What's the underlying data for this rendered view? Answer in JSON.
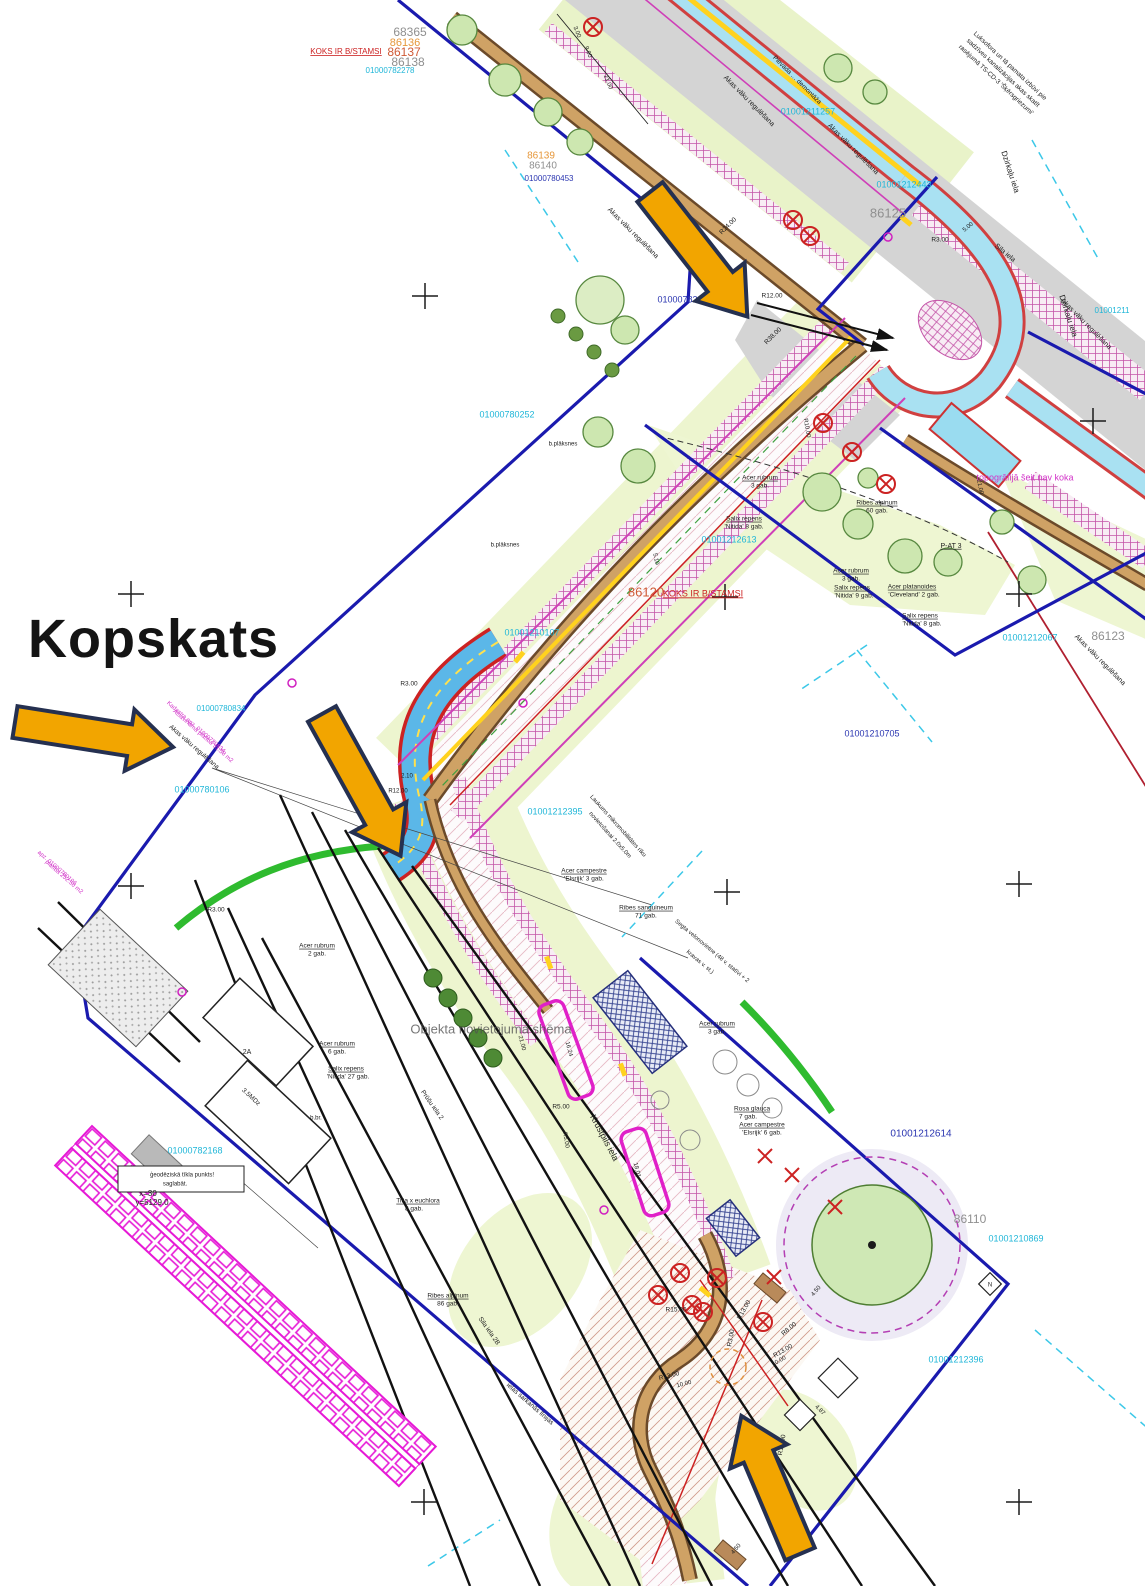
{
  "title": "Kopskats",
  "palette": {
    "cyan": "#1fb6d8",
    "blue": "#2a35b0",
    "red": "#cc2222",
    "magenta": "#d233c8",
    "orange": "#e6973a",
    "orangered": "#cf5a36",
    "dim": "#8f8f8f",
    "black": "#1d1d1d",
    "shadow": "rgba(80,80,80,0.78)",
    "arrow_fill": "#f2a500",
    "arrow_edge": "#253050"
  },
  "labels": [
    {
      "t": "68365",
      "x": 410,
      "y": 33,
      "c": "dim",
      "s": 12
    },
    {
      "t": "86136",
      "x": 405,
      "y": 43,
      "c": "orange",
      "s": 11
    },
    {
      "t": "KOKS IR B/STAMSI",
      "x": 346,
      "y": 52,
      "c": "red",
      "s": 8,
      "u": 1
    },
    {
      "t": "86137",
      "x": 404,
      "y": 53,
      "c": "orangered",
      "s": 12
    },
    {
      "t": "86138",
      "x": 408,
      "y": 63,
      "c": "dim",
      "s": 12
    },
    {
      "t": "01000782278",
      "x": 390,
      "y": 71,
      "c": "cyan",
      "s": 8
    },
    {
      "t": "86139",
      "x": 541,
      "y": 156,
      "c": "orange",
      "s": 10
    },
    {
      "t": "86140",
      "x": 543,
      "y": 166,
      "c": "dim",
      "s": 10
    },
    {
      "t": "01000780453",
      "x": 549,
      "y": 179,
      "c": "blue",
      "s": 8
    },
    {
      "t": "Luksofora un tā pamata izbūvi pie",
      "x": 1010,
      "y": 66,
      "r": 43,
      "s": 6.5
    },
    {
      "t": "sadzīves kanalizācijas akas skatīt",
      "x": 1003,
      "y": 73,
      "r": 43,
      "s": 6.5
    },
    {
      "t": "rasējumā TS-CD-3 'Šķērsgriezumi'",
      "x": 996,
      "y": 80,
      "r": 43,
      "s": 6.5
    },
    {
      "t": "Pievada … demontāža",
      "x": 797,
      "y": 80,
      "r": 45,
      "s": 6.5
    },
    {
      "t": "Akas vāku regulēšana",
      "x": 749,
      "y": 101,
      "r": 45,
      "s": 7
    },
    {
      "t": "Akas vāku regulēšana",
      "x": 853,
      "y": 149,
      "r": 45,
      "s": 7
    },
    {
      "t": "Akas vāku regulēšana",
      "x": 633,
      "y": 233,
      "r": 45,
      "s": 7
    },
    {
      "t": "Akas vāku regulēšana",
      "x": 1086,
      "y": 324,
      "r": 45,
      "s": 7
    },
    {
      "t": "Dzirkaļu iela",
      "x": 1010,
      "y": 172,
      "r": 72,
      "s": 8
    },
    {
      "t": "Dzirkaļu iela",
      "x": 1068,
      "y": 316,
      "r": 72,
      "s": 8
    },
    {
      "t": "01001211257",
      "x": 808,
      "y": 112,
      "c": "cyan",
      "s": 9
    },
    {
      "t": "01001212443",
      "x": 904,
      "y": 185,
      "c": "cyan",
      "s": 9
    },
    {
      "t": "86125",
      "x": 888,
      "y": 214,
      "c": "dim",
      "s": 13
    },
    {
      "t": "Sila iela",
      "x": 1005,
      "y": 253,
      "r": 40,
      "s": 7
    },
    {
      "t": "01001211",
      "x": 1112,
      "y": 311,
      "c": "cyan",
      "s": 8
    },
    {
      "t": "01000782230",
      "x": 685,
      "y": 300,
      "c": "blue",
      "s": 9
    },
    {
      "t": "R24.00",
      "x": 728,
      "y": 226,
      "r": -45,
      "s": 6.5
    },
    {
      "t": "3.00",
      "x": 577,
      "y": 32,
      "r": 68,
      "s": 6
    },
    {
      "t": "9.00",
      "x": 588,
      "y": 52,
      "r": 68,
      "s": 6
    },
    {
      "t": "21.00",
      "x": 608,
      "y": 82,
      "r": 68,
      "s": 6
    },
    {
      "t": "R12.00",
      "x": 772,
      "y": 296,
      "s": 6.5
    },
    {
      "t": "R38.00",
      "x": 773,
      "y": 336,
      "r": -45,
      "s": 6.5
    },
    {
      "t": "R3.00",
      "x": 940,
      "y": 240,
      "s": 6.5
    },
    {
      "t": "5.00",
      "x": 968,
      "y": 227,
      "r": -40,
      "s": 6
    },
    {
      "t": "01000780252",
      "x": 507,
      "y": 415,
      "c": "cyan",
      "s": 9
    },
    {
      "t": "b.plāksnes",
      "x": 563,
      "y": 444,
      "s": 6
    },
    {
      "t": "b.plāksnes",
      "x": 505,
      "y": 545,
      "s": 6
    },
    {
      "t": "86120",
      "x": 646,
      "y": 593,
      "c": "orangered",
      "s": 13
    },
    {
      "t": "KOKS IR B/STAMSI",
      "x": 703,
      "y": 594,
      "c": "red",
      "s": 9,
      "u": 1
    },
    {
      "t": "01001212613",
      "x": 729,
      "y": 540,
      "c": "cyan",
      "s": 9
    },
    {
      "t": "R10.00",
      "x": 807,
      "y": 428,
      "r": 80,
      "s": 6
    },
    {
      "t": "Acer rubrum",
      "x": 760,
      "y": 478,
      "s": 6.5,
      "u": 1
    },
    {
      "t": "3 gab.",
      "x": 760,
      "y": 486,
      "s": 6.5
    },
    {
      "t": "Ribes alpinum",
      "x": 877,
      "y": 503,
      "s": 6.5,
      "u": 1
    },
    {
      "t": "60 gab.",
      "x": 877,
      "y": 511,
      "s": 6.5
    },
    {
      "t": "Salix repens",
      "x": 744,
      "y": 519,
      "s": 6.5,
      "u": 1
    },
    {
      "t": "'Nitida' 8 gab.",
      "x": 744,
      "y": 527,
      "s": 6.5
    },
    {
      "t": "P-AT 3",
      "x": 951,
      "y": 546,
      "s": 7,
      "u": 1
    },
    {
      "t": "21.00",
      "x": 980,
      "y": 487,
      "r": 78,
      "s": 6
    },
    {
      "t": "Acer rubrum",
      "x": 851,
      "y": 571,
      "s": 6.5,
      "u": 1
    },
    {
      "t": "3 gab.",
      "x": 851,
      "y": 579,
      "s": 6.5
    },
    {
      "t": "Salix repens",
      "x": 852,
      "y": 588,
      "s": 6.5,
      "u": 1
    },
    {
      "t": "'Nitida' 9 gab.",
      "x": 854,
      "y": 596,
      "s": 6.5
    },
    {
      "t": "Acer platanoides",
      "x": 912,
      "y": 587,
      "s": 6.5,
      "u": 1
    },
    {
      "t": "'Cleveland' 2 gab.",
      "x": 914,
      "y": 595,
      "s": 6.5
    },
    {
      "t": "Salix repens",
      "x": 920,
      "y": 616,
      "s": 6.5,
      "u": 1
    },
    {
      "t": "'Nitida' 8 gab.",
      "x": 922,
      "y": 624,
      "s": 6.5
    },
    {
      "t": "topogrāfijā šeit nav koka",
      "x": 1025,
      "y": 478,
      "c": "magenta",
      "s": 9
    },
    {
      "t": "01001212067",
      "x": 1030,
      "y": 638,
      "c": "cyan",
      "s": 9
    },
    {
      "t": "86123",
      "x": 1108,
      "y": 637,
      "c": "dim",
      "s": 12
    },
    {
      "t": "Akas vāku regulēšana",
      "x": 1100,
      "y": 660,
      "r": 45,
      "s": 7
    },
    {
      "t": "01001210705",
      "x": 872,
      "y": 734,
      "c": "blue",
      "s": 9
    },
    {
      "t": "01001210107",
      "x": 532,
      "y": 633,
      "c": "cyan",
      "s": 9
    },
    {
      "t": "R3.00",
      "x": 409,
      "y": 684,
      "s": 6.5
    },
    {
      "t": "2.10",
      "x": 407,
      "y": 776,
      "s": 6
    },
    {
      "t": "R12.00",
      "x": 398,
      "y": 791,
      "s": 6
    },
    {
      "t": "5.10",
      "x": 656,
      "y": 559,
      "r": 78,
      "s": 6
    },
    {
      "t": "01000780834",
      "x": 221,
      "y": 709,
      "c": "cyan",
      "s": 8
    },
    {
      "t": "Kadastra apz. 01000780834",
      "x": 196,
      "y": 727,
      "r": 41,
      "c": "magenta",
      "s": 6
    },
    {
      "t": "Atsavināmā platība 51.58 m2",
      "x": 203,
      "y": 736,
      "r": 41,
      "c": "magenta",
      "s": 6
    },
    {
      "t": "Akas vāku regulēšana",
      "x": 194,
      "y": 747,
      "r": 41,
      "s": 6.5
    },
    {
      "t": "01000780106",
      "x": 202,
      "y": 790,
      "c": "cyan",
      "s": 9
    },
    {
      "t": "apz. 01000780106",
      "x": 57,
      "y": 868,
      "r": 41,
      "c": "magenta",
      "s": 6
    },
    {
      "t": "platība 252.50 m2",
      "x": 64,
      "y": 877,
      "r": 41,
      "c": "magenta",
      "s": 6
    },
    {
      "t": "R3.00",
      "x": 216,
      "y": 910,
      "s": 6.5
    },
    {
      "t": "01001212395",
      "x": 555,
      "y": 812,
      "c": "cyan",
      "s": 9
    },
    {
      "t": "Laukums mikromobilitātes rīku",
      "x": 618,
      "y": 826,
      "r": 48,
      "s": 6
    },
    {
      "t": "novietošanai 2.0x5.0m",
      "x": 610,
      "y": 835,
      "r": 48,
      "s": 6
    },
    {
      "t": "Acer campestre",
      "x": 584,
      "y": 871,
      "s": 6.5,
      "u": 1
    },
    {
      "t": "'Elsrijk' 3 gab.",
      "x": 584,
      "y": 879,
      "s": 6.5
    },
    {
      "t": "Ribes sanguineum",
      "x": 646,
      "y": 908,
      "s": 6.5,
      "u": 1
    },
    {
      "t": "71 gab.",
      "x": 646,
      "y": 916,
      "s": 6.5
    },
    {
      "t": "Segta velonovietne (48 v. statīvi + 2",
      "x": 712,
      "y": 951,
      "r": 40,
      "s": 6
    },
    {
      "t": "kravas v. st.)",
      "x": 700,
      "y": 962,
      "r": 40,
      "s": 6
    },
    {
      "t": "Acer rubrum",
      "x": 717,
      "y": 1024,
      "s": 6.5,
      "u": 1
    },
    {
      "t": "3 gab.",
      "x": 717,
      "y": 1032,
      "s": 6.5
    },
    {
      "t": "Acer rubrum",
      "x": 317,
      "y": 946,
      "s": 6.5,
      "u": 1
    },
    {
      "t": "2 gab.",
      "x": 317,
      "y": 954,
      "s": 6.5
    },
    {
      "t": "Acer rubrum",
      "x": 337,
      "y": 1044,
      "s": 6.5,
      "u": 1
    },
    {
      "t": "6 gab.",
      "x": 337,
      "y": 1052,
      "s": 6.5
    },
    {
      "t": "Salix repens",
      "x": 346,
      "y": 1069,
      "s": 6.5,
      "u": 1
    },
    {
      "t": "'Nitida' 27 gab.",
      "x": 348,
      "y": 1077,
      "s": 6.5
    },
    {
      "t": "Objekta novietojuma shēma",
      "x": 491,
      "y": 1030,
      "c": "shadow",
      "s": 13
    },
    {
      "t": "Prūšu iela 2",
      "x": 432,
      "y": 1105,
      "r": 55,
      "s": 6.5
    },
    {
      "t": "Krustpils iela",
      "x": 604,
      "y": 1138,
      "r": 62,
      "s": 9
    },
    {
      "t": "16.24",
      "x": 569,
      "y": 1049,
      "r": 75,
      "s": 6
    },
    {
      "t": "21.00",
      "x": 522,
      "y": 1043,
      "r": 75,
      "s": 6
    },
    {
      "t": "R5.00",
      "x": 561,
      "y": 1107,
      "s": 6.5
    },
    {
      "t": "R5.00",
      "x": 566,
      "y": 1140,
      "r": 80,
      "s": 6
    },
    {
      "t": "2A",
      "x": 247,
      "y": 1052,
      "s": 7
    },
    {
      "t": "3.5MDz",
      "x": 251,
      "y": 1097,
      "r": 43,
      "s": 6.5
    },
    {
      "t": "b.br.",
      "x": 316,
      "y": 1118,
      "s": 6
    },
    {
      "t": "01000782168",
      "x": 195,
      "y": 1151,
      "c": "cyan",
      "s": 9
    },
    {
      "t": "ģeodēziskā tīkla punkts!",
      "x": 182,
      "y": 1175,
      "s": 6
    },
    {
      "t": "saglabāt.",
      "x": 175,
      "y": 1184,
      "s": 6
    },
    {
      "t": "x=30",
      "x": 148,
      "y": 1194,
      "s": 8
    },
    {
      "t": "y=5129.0",
      "x": 152,
      "y": 1203,
      "s": 8
    },
    {
      "t": "Rosa glauca",
      "x": 752,
      "y": 1109,
      "s": 6.5,
      "u": 1
    },
    {
      "t": "7 gab.",
      "x": 748,
      "y": 1117,
      "s": 6.5
    },
    {
      "t": "Acer campestre",
      "x": 762,
      "y": 1125,
      "s": 6.5,
      "u": 1
    },
    {
      "t": "'Elsrijk' 6 gab.",
      "x": 762,
      "y": 1133,
      "s": 6.5
    },
    {
      "t": "01001212614",
      "x": 921,
      "y": 1134,
      "c": "blue",
      "s": 10
    },
    {
      "t": "86110",
      "x": 970,
      "y": 1220,
      "c": "dim",
      "s": 12
    },
    {
      "t": "01001210869",
      "x": 1016,
      "y": 1239,
      "c": "cyan",
      "s": 9
    },
    {
      "t": "18.01",
      "x": 637,
      "y": 1170,
      "r": 75,
      "s": 6
    },
    {
      "t": "Tilia x euchlora",
      "x": 418,
      "y": 1201,
      "s": 6.5,
      "u": 1
    },
    {
      "t": "8 gab.",
      "x": 414,
      "y": 1209,
      "s": 6.5
    },
    {
      "t": "Ribes alpinum",
      "x": 448,
      "y": 1296,
      "s": 6.5,
      "u": 1
    },
    {
      "t": "86 gab.",
      "x": 448,
      "y": 1304,
      "s": 6.5
    },
    {
      "t": "Sila iela 2B",
      "x": 489,
      "y": 1331,
      "r": 55,
      "s": 6.5
    },
    {
      "t": "ielas sarkanās līnijas",
      "x": 530,
      "y": 1404,
      "r": 41,
      "s": 6.5
    },
    {
      "t": "R15.00",
      "x": 676,
      "y": 1310,
      "s": 6.5
    },
    {
      "t": "R13.00",
      "x": 744,
      "y": 1310,
      "r": -60,
      "s": 6.5
    },
    {
      "t": "R3.00",
      "x": 731,
      "y": 1338,
      "r": -80,
      "s": 6.5
    },
    {
      "t": "R8.00",
      "x": 789,
      "y": 1329,
      "r": -40,
      "s": 6.5
    },
    {
      "t": "R13.00",
      "x": 783,
      "y": 1351,
      "r": -30,
      "s": 6.5
    },
    {
      "t": "10.00",
      "x": 779,
      "y": 1361,
      "r": -30,
      "s": 6
    },
    {
      "t": "R13.00",
      "x": 669,
      "y": 1376,
      "r": -15,
      "s": 6.5
    },
    {
      "t": "10.00",
      "x": 684,
      "y": 1384,
      "r": -15,
      "s": 6
    },
    {
      "t": "R13.00",
      "x": 782,
      "y": 1445,
      "r": -80,
      "s": 6.5
    },
    {
      "t": "4.87",
      "x": 820,
      "y": 1410,
      "r": 45,
      "s": 6
    },
    {
      "t": "4.50",
      "x": 816,
      "y": 1291,
      "r": -50,
      "s": 6
    },
    {
      "t": "4.50",
      "x": 736,
      "y": 1549,
      "r": -50,
      "s": 6
    },
    {
      "t": "01001212396",
      "x": 956,
      "y": 1360,
      "c": "cyan",
      "s": 9
    },
    {
      "t": "N",
      "x": 990,
      "y": 1285,
      "s": 6
    }
  ],
  "crosses": [
    [
      425,
      296
    ],
    [
      131,
      594
    ],
    [
      725,
      597
    ],
    [
      1019,
      594
    ],
    [
      1093,
      421
    ],
    [
      131,
      886
    ],
    [
      727,
      892
    ],
    [
      1019,
      884
    ],
    [
      424,
      1502
    ],
    [
      1019,
      1502
    ]
  ],
  "arrows": [
    {
      "x": 650,
      "y": 192,
      "angle": 52,
      "len": 158
    },
    {
      "x": 15,
      "y": 722,
      "angle": 9,
      "len": 160
    },
    {
      "x": 322,
      "y": 714,
      "angle": 61,
      "len": 162
    },
    {
      "x": 800,
      "y": 1554,
      "angle": -113,
      "len": 150
    }
  ]
}
